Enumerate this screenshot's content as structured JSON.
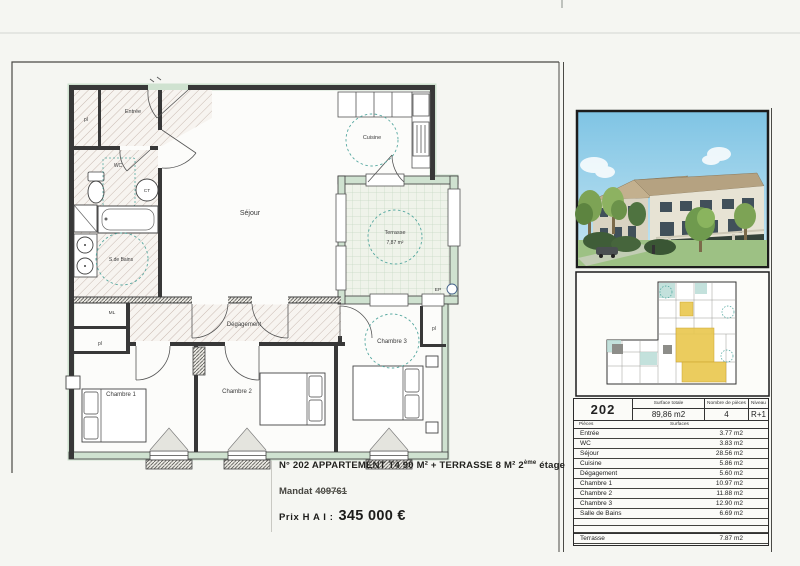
{
  "page": {
    "caption_line1_main": "N° 202 APPARTEMENT T4 90 M² + TERRASSE 8 M² 2",
    "caption_line1_sup": "ème",
    "caption_line1_end": " étage",
    "mandat_label": "Mandat",
    "mandat_value": "409761",
    "prix_label": "Prix H A I :",
    "prix_value": "345 000 €"
  },
  "plan": {
    "labels": {
      "entree": "Entrée",
      "pl": "pl",
      "wc": "WC",
      "ct": "CT",
      "sdb": "S.de Bains",
      "ml": "ML",
      "sejour": "Séjour",
      "cuisine": "Cuisine",
      "terrasse": "Terrasse",
      "terrasse_area": "7,87 m²",
      "degagement": "Dégagement",
      "chambre1": "Chambre 1",
      "chambre2": "Chambre 2",
      "chambre3": "Chambre 3",
      "ep": "EP"
    }
  },
  "panel": {
    "table": {
      "apartment_number": "202",
      "surface_totale_label": "Surface totale",
      "surface_totale_value": "89,86 m2",
      "nb_pieces_label": "Nombre de pièces",
      "nb_pieces_value": "4",
      "niveau_label": "Niveau",
      "niveau_value": "R+1",
      "col_pieces": "Pièces",
      "col_surfaces": "Surfaces",
      "rows": [
        {
          "label": "Entrée",
          "value": "3.77 m2"
        },
        {
          "label": "WC",
          "value": "3.83 m2"
        },
        {
          "label": "Séjour",
          "value": "28.56 m2"
        },
        {
          "label": "Cuisine",
          "value": "5.86 m2"
        },
        {
          "label": "Dégagement",
          "value": "5.60 m2"
        },
        {
          "label": "Chambre 1",
          "value": "10.97 m2"
        },
        {
          "label": "Chambre 2",
          "value": "11.88 m2"
        },
        {
          "label": "Chambre 3",
          "value": "12.90 m2"
        },
        {
          "label": "Salle de Bains",
          "value": "6.69 m2"
        }
      ],
      "terrasse_row": {
        "label": "Terrasse",
        "value": "7.87 m2"
      }
    }
  }
}
